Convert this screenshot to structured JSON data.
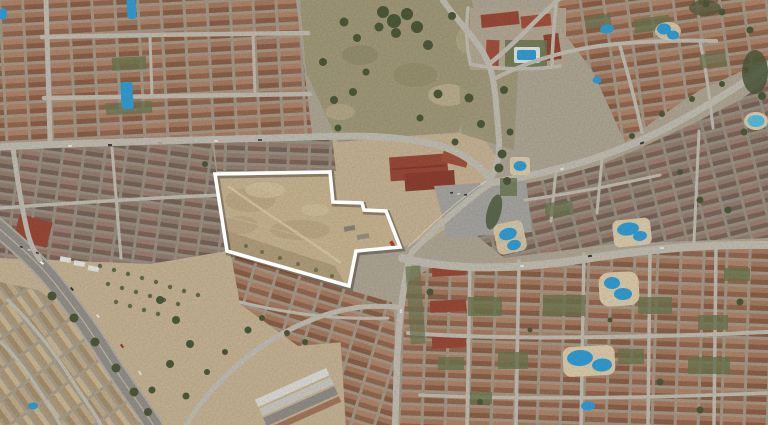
{
  "map": {
    "view": "satellite-aerial-photo",
    "colors": {
      "parcel_outline": "#ffffff",
      "parcel_ground": "#c9b590",
      "terrain_sand": "#c7b494",
      "terrain_scrub": "#a29a79",
      "urban_base": "#b0a794",
      "road_light": "#c2beb2",
      "road_dark": "#95918a",
      "pool_blue": "#2f9fd8",
      "pool_deck": "#dbcca9",
      "vegetation_dark": "#4e5a39",
      "courtyard_green": "#6d7850",
      "roof_red": "#9d4a37",
      "warehouse_white": "#dedcd6"
    }
  },
  "overlay": {
    "parcel_outline": {
      "points": "215,174 330,172 333,202 362,203 364,210 386,211 400,247 356,251 349,286 227,251",
      "stroke_width": 3.6
    }
  }
}
